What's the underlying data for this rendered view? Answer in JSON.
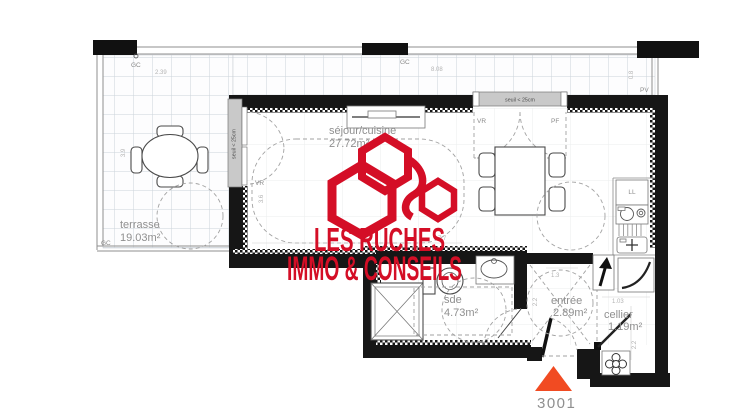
{
  "unit": {
    "number": "3001"
  },
  "logo": {
    "line1": "LES RUCHES",
    "line2": "IMMO & CONSEILS"
  },
  "rooms": {
    "terrasse": {
      "name": "terrasse",
      "area": "19.03m²"
    },
    "sejour": {
      "name": "séjour/cuisine",
      "area": "27.72m²"
    },
    "sde": {
      "name": "sde",
      "area": "4.73m²"
    },
    "entree": {
      "name": "entrée",
      "area": "2.89m²"
    },
    "cellier": {
      "name": "cellier",
      "area": "1.19m²"
    }
  },
  "annotations": {
    "gc_top_left": "GC",
    "gc_top_mid": "GC",
    "gc_bottom_left": "GC",
    "pv": "PV",
    "seuil_top": "seuil < 25cm",
    "seuil_left": "seuil < 25cm",
    "vr_top_window": "VR",
    "pf_top_window": "PF",
    "vr_left_window": "VR",
    "washing_machine": "LL"
  },
  "dimensions": {
    "terrace_width_left": "2.39",
    "terrace_width_top": "8.08",
    "terrace_depth": "3.9",
    "railing_right": "0.8",
    "sejour_width": "7.7",
    "left_window_height": "3.6",
    "entree_width": "1.3",
    "entree_depth": "2.2",
    "cellier_width": "1.03",
    "cellier_depth": "2.2"
  },
  "colors": {
    "logo_red": "#d40e26",
    "triangle_orange": "#f14b22",
    "wall_black": "#161616",
    "label_gray": "#8f8f8f"
  }
}
